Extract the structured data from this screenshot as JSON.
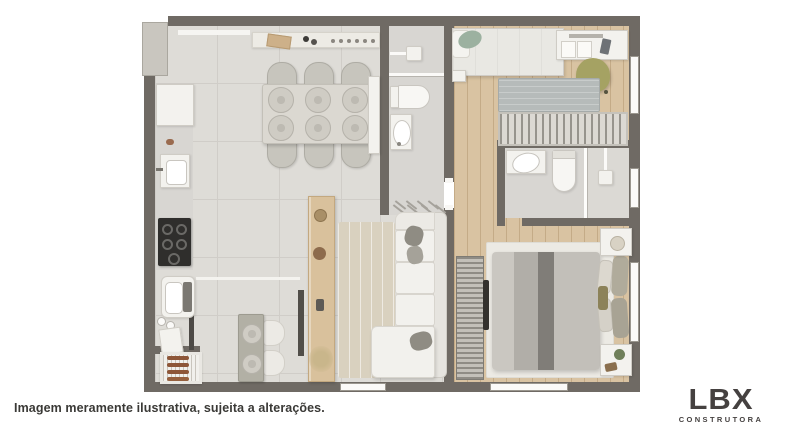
{
  "footer": {
    "disclaimer": "Imagem meramente ilustrativa, sujeita a alterações."
  },
  "logo": {
    "name": "LBX",
    "subtitle": "CONSTRUTORA"
  },
  "colors": {
    "wall": "#6f6a64",
    "shaft": "#c9c6bf",
    "tile": "#dedcd7",
    "tile-line": "#d0cdc8",
    "wood": "#d9c3a2",
    "wood-line": "#c4ab87",
    "bath": "#d8d6d2",
    "shower": "#dbd9d4",
    "sofa": "#f2f1ed",
    "pillow": "#8f8c83",
    "rug-living": "#d9d1bf",
    "rug-b2": "#b6bbba",
    "rug-master": "#eceae4",
    "cooktop": "#2f2e2c",
    "sideboard": "#d9c19c",
    "olive": "#a5a263",
    "pgreen": "#9cb1a0",
    "duv1": "#cac7c1",
    "duv2": "#b1aea8",
    "duv3": "#807d78",
    "duv4": "#c2bfb9",
    "txt": "#3a3936",
    "logo": "#454140"
  },
  "floorplan": {
    "type": "apartment-floor-plan",
    "rooms": [
      "kitchen",
      "dining-area",
      "living-room",
      "grill-nook",
      "bathroom-1",
      "bedroom-2",
      "bathroom-2",
      "corridor",
      "master-bedroom"
    ],
    "furniture": [
      "fridge",
      "kitchen-sink",
      "cooktop",
      "laundry-tub",
      "barbecue-grill",
      "buffet-counter",
      "dining-table-6-chairs",
      "bistro-table-2-seats",
      "wood-sideboard",
      "area-rug",
      "l-shaped-sofa",
      "tv-slat-panel",
      "double-bed",
      "nightstands",
      "single-bed",
      "desk",
      "office-chair",
      "wardrobe",
      "toilet",
      "washbasin",
      "shower"
    ]
  }
}
